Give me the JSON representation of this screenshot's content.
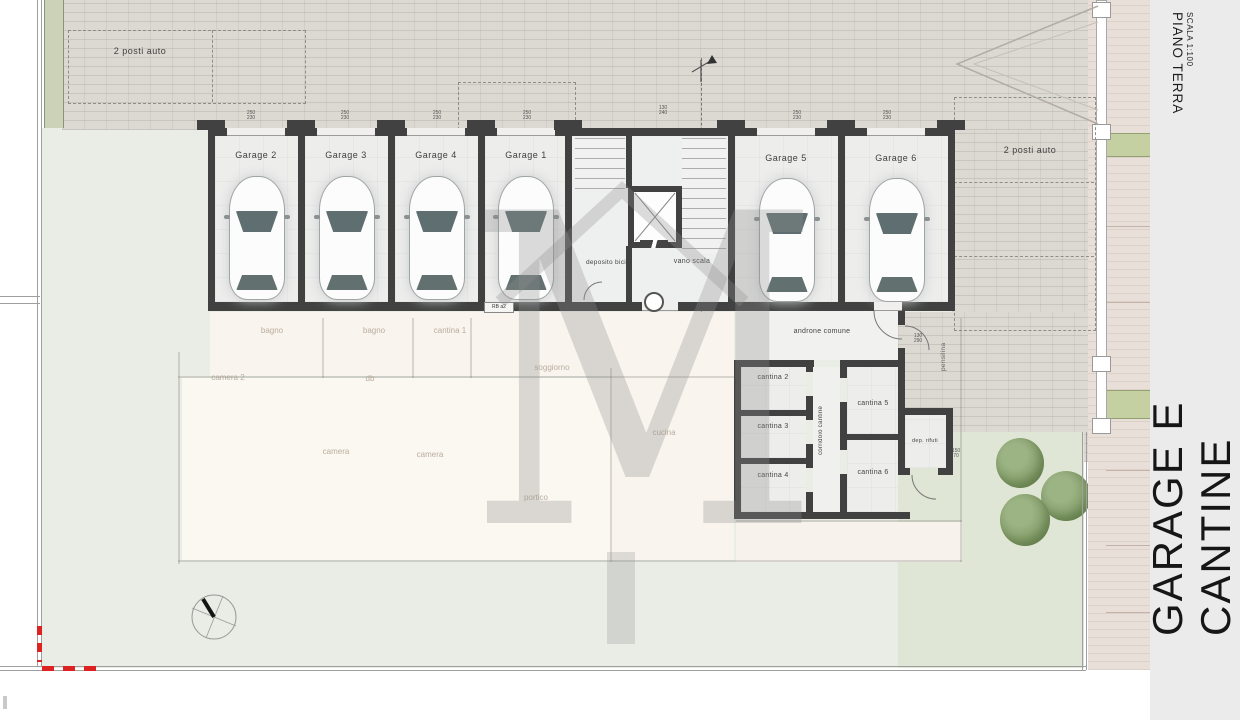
{
  "sidebar": {
    "plan_title": "GARAGE E CANTINE",
    "header_line1": "PIANO TERRA",
    "header_line2": "SCALA 1:100"
  },
  "parking": {
    "left": "2 posti auto",
    "right": "2 posti auto"
  },
  "garages": [
    "Garage 2",
    "Garage 3",
    "Garage 4",
    "Garage 1",
    "Garage 5",
    "Garage 6"
  ],
  "core": {
    "deposito": "deposito bici",
    "vano_scala": "vano scala"
  },
  "cantine": {
    "androne": "androne comune",
    "corridoio": "corridoio cantine",
    "c2": "cantina 2",
    "c3": "cantina 3",
    "c4": "cantina 4",
    "c5": "cantina 5",
    "c6": "cantina 6",
    "rifiuti": "dep. rifuti",
    "pensilina": "pensilina",
    "rb": "RB a2"
  },
  "dims": {
    "door_w": "250",
    "door_h": "230",
    "core_w": "130",
    "core_h": "240",
    "androne_w": "130",
    "androne_h": "290",
    "rifiuti_w": "150",
    "rifiuti_h": "70"
  },
  "faded_rooms": [
    "bagno",
    "bagno",
    "cantina 1",
    "camera 2",
    "db",
    "soggiorno",
    "camera",
    "camera",
    "cucina",
    "portico"
  ],
  "watermark_letter": "M",
  "colors": {
    "wall": "#414141",
    "paving": "#dcd9d3",
    "lawn": "#e9ede5",
    "lawn_dark": "#dfe6d5",
    "hedge": "#ccd2b8",
    "green_band": "#c4cfa2",
    "tree": "#86a06c",
    "strip": "#e8dfd8",
    "sidebar_bg": "#ebebeb",
    "boundary_red": "#dd2222"
  }
}
